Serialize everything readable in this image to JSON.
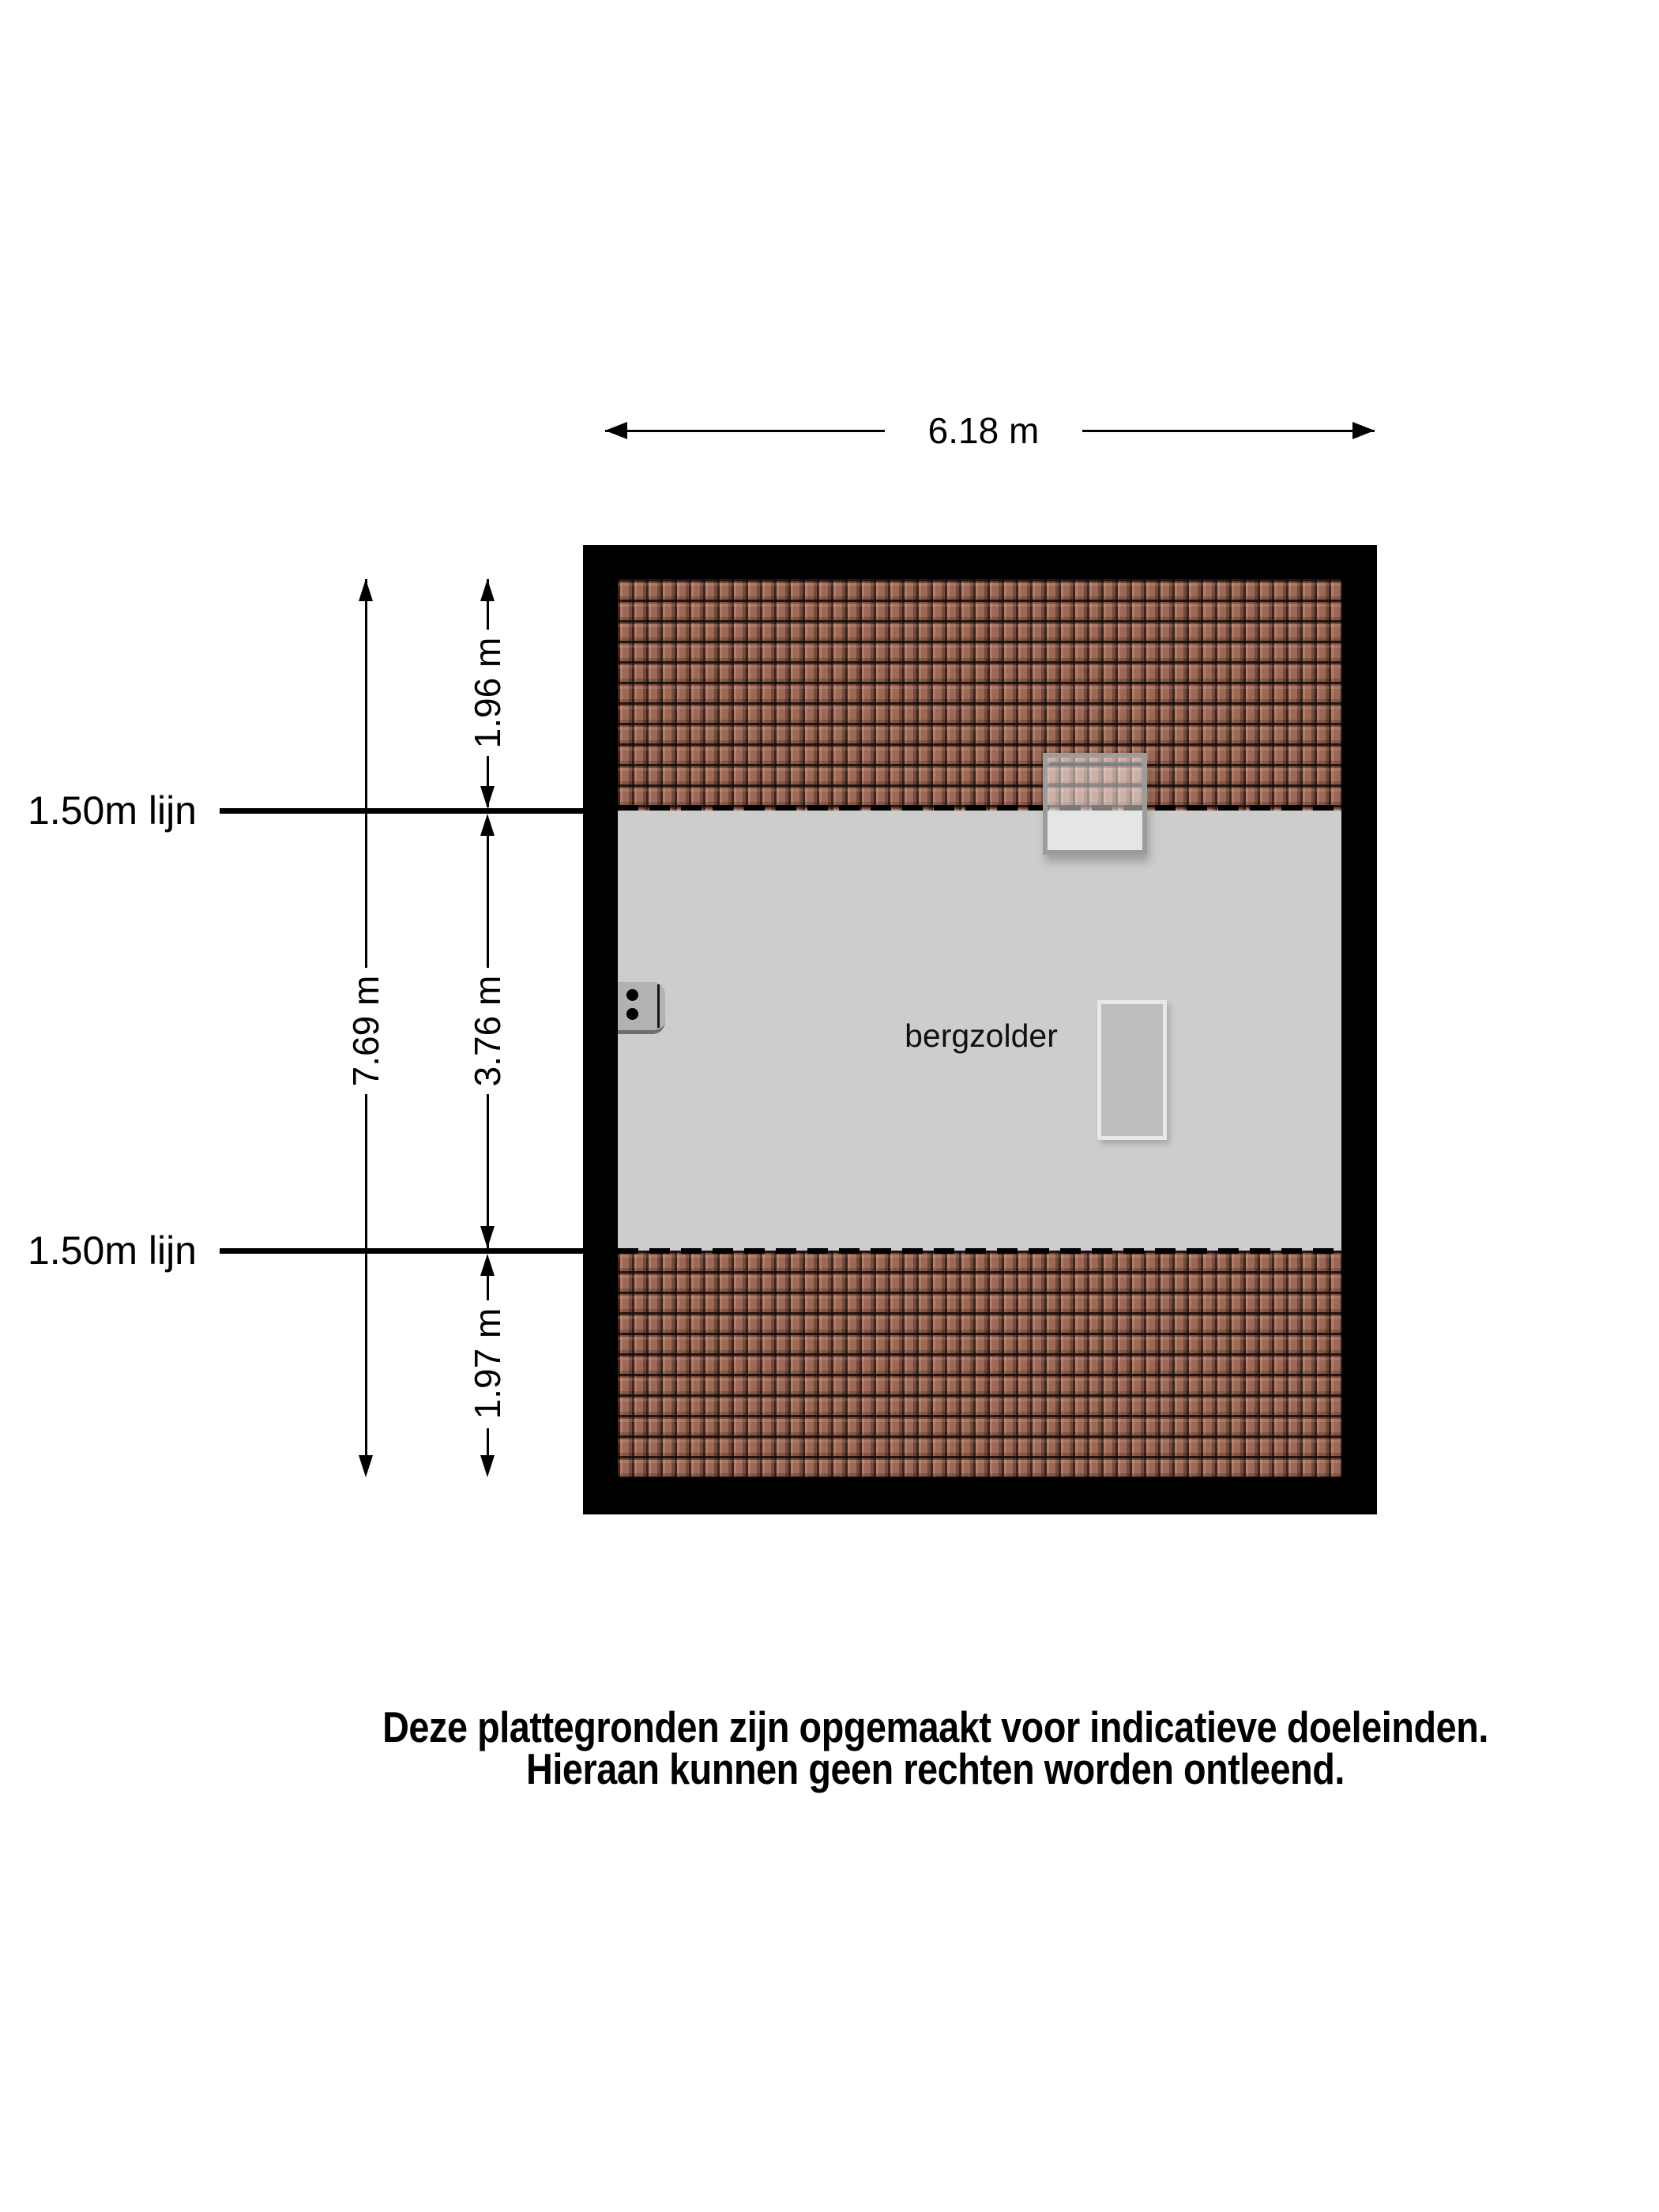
{
  "room": {
    "label": "bergzolder"
  },
  "dims": {
    "total_width": "6.18 m",
    "total_height": "7.69 m",
    "section_top": "1.96 m",
    "section_middle": "3.76 m",
    "section_bottom": "1.97 m"
  },
  "reference_lines": {
    "top_label": "1.50m lijn",
    "bottom_label": "1.50m lijn"
  },
  "disclaimer": {
    "line1": "Deze plattegronden zijn opgemaakt voor indicatieve doeleinden.",
    "line2": "Hieraan kunnen geen rechten worden ontleend."
  },
  "colors": {
    "wall": "#000000",
    "floor": "#cdcdcd",
    "tile": "#9d6854",
    "line": "#000000",
    "skylight_frame": "#9c9c9c",
    "stair_border": "#e8e8e8",
    "stair_fill": "#bdbdbd",
    "unit_gray": "#b2b2b2"
  }
}
